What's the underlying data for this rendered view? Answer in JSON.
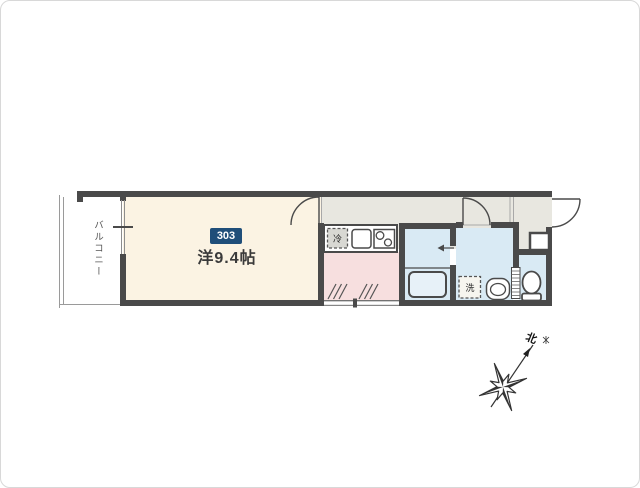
{
  "floorplan": {
    "unit_badge": "303",
    "main_room_label": "洋9.4帖",
    "balcony_label": "バルコニー",
    "refrigerator_label": "冷",
    "washing_machine_label": "洗",
    "compass_north_label": "北",
    "colors": {
      "wall": "#4a4a4a",
      "main_room_floor": "#fbf3e3",
      "hallway_floor": "#e8e7e0",
      "kitchen_floor": "#f7dfdf",
      "wet_area_floor": "#d9eaf4",
      "unit_badge_bg": "#1f4e79"
    }
  }
}
